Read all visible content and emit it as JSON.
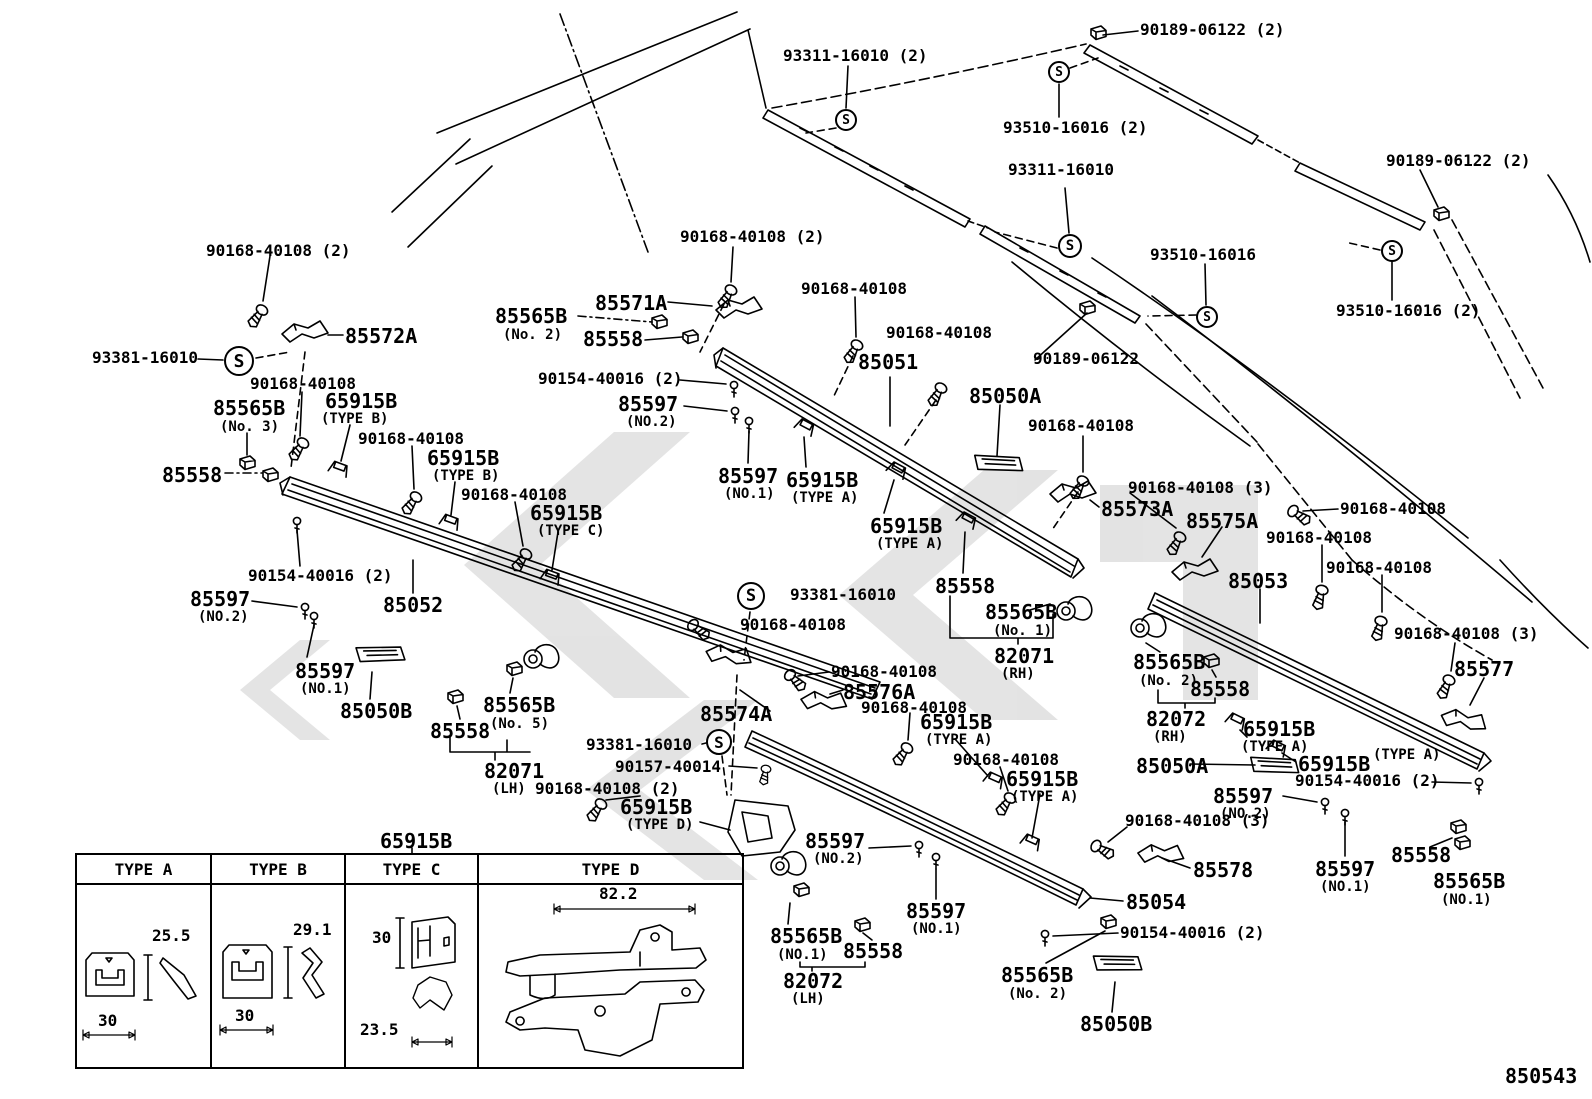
{
  "figure": {
    "number": "850543"
  },
  "s_symbol": "S",
  "watermark_color": "#c9c9c9",
  "table": {
    "title": "65915B",
    "headers": [
      "TYPE A",
      "TYPE B",
      "TYPE C",
      "TYPE D"
    ],
    "dims": {
      "a_h": "25.5",
      "a_w": "30",
      "b_h": "29.1",
      "b_w": "30",
      "c_h": "30",
      "c_w": "23.5",
      "d_w": "82.2"
    }
  },
  "s_marks": [
    {
      "x": 846,
      "y": 120,
      "r": 11
    },
    {
      "x": 1059,
      "y": 72,
      "r": 11
    },
    {
      "x": 1070,
      "y": 246,
      "r": 12
    },
    {
      "x": 1207,
      "y": 317,
      "r": 11
    },
    {
      "x": 1392,
      "y": 251,
      "r": 11
    },
    {
      "x": 239,
      "y": 361,
      "r": 15
    },
    {
      "x": 751,
      "y": 596,
      "r": 14
    },
    {
      "x": 719,
      "y": 742,
      "r": 13
    }
  ],
  "labels": [
    {
      "t": "90189-06122 (2)",
      "x": 1140,
      "y": 22,
      "c": "n"
    },
    {
      "t": "93311-16010 (2)",
      "x": 783,
      "y": 48,
      "c": "n"
    },
    {
      "t": "93510-16016 (2)",
      "x": 1003,
      "y": 120,
      "c": "n"
    },
    {
      "t": "93311-16010",
      "x": 1008,
      "y": 162,
      "c": "n"
    },
    {
      "t": "90189-06122 (2)",
      "x": 1386,
      "y": 153,
      "c": "n"
    },
    {
      "t": "90168-40108 (2)",
      "x": 680,
      "y": 229,
      "c": "n"
    },
    {
      "t": "93510-16016",
      "x": 1150,
      "y": 247,
      "c": "n"
    },
    {
      "t": "90168-40108",
      "x": 801,
      "y": 281,
      "c": "n"
    },
    {
      "t": "85571A",
      "x": 595,
      "y": 293,
      "c": "b"
    },
    {
      "t": "85565B",
      "x": 495,
      "y": 306,
      "c": "b"
    },
    {
      "t": "(No. 2)",
      "x": 503,
      "y": 328,
      "c": "s"
    },
    {
      "t": "85558",
      "x": 583,
      "y": 329,
      "c": "b"
    },
    {
      "t": "93510-16016 (2)",
      "x": 1336,
      "y": 303,
      "c": "n"
    },
    {
      "t": "90168-40108 (2)",
      "x": 206,
      "y": 243,
      "c": "n"
    },
    {
      "t": "85572A",
      "x": 345,
      "y": 326,
      "c": "b"
    },
    {
      "t": "93381-16010",
      "x": 92,
      "y": 350,
      "c": "n"
    },
    {
      "t": "90168-40108",
      "x": 886,
      "y": 325,
      "c": "n"
    },
    {
      "t": "90189-06122",
      "x": 1033,
      "y": 351,
      "c": "n"
    },
    {
      "t": "85051",
      "x": 858,
      "y": 352,
      "c": "b"
    },
    {
      "t": "90168-40108",
      "x": 1028,
      "y": 418,
      "c": "n"
    },
    {
      "t": "85050A",
      "x": 969,
      "y": 386,
      "c": "b"
    },
    {
      "t": "90154-40016 (2)",
      "x": 538,
      "y": 371,
      "c": "n"
    },
    {
      "t": "85597",
      "x": 618,
      "y": 394,
      "c": "b"
    },
    {
      "t": "(NO.2)",
      "x": 626,
      "y": 415,
      "c": "s"
    },
    {
      "t": "90168-40108",
      "x": 250,
      "y": 376,
      "c": "n"
    },
    {
      "t": "85565B",
      "x": 213,
      "y": 398,
      "c": "b"
    },
    {
      "t": "(No. 3)",
      "x": 220,
      "y": 420,
      "c": "s"
    },
    {
      "t": "65915B",
      "x": 325,
      "y": 391,
      "c": "b"
    },
    {
      "t": "(TYPE B)",
      "x": 321,
      "y": 412,
      "c": "s"
    },
    {
      "t": "85558",
      "x": 162,
      "y": 465,
      "c": "b"
    },
    {
      "t": "90168-40108",
      "x": 358,
      "y": 431,
      "c": "n"
    },
    {
      "t": "65915B",
      "x": 427,
      "y": 448,
      "c": "b"
    },
    {
      "t": "(TYPE B)",
      "x": 432,
      "y": 469,
      "c": "s"
    },
    {
      "t": "90168-40108",
      "x": 461,
      "y": 487,
      "c": "n"
    },
    {
      "t": "65915B",
      "x": 530,
      "y": 503,
      "c": "b"
    },
    {
      "t": "(TYPE C)",
      "x": 537,
      "y": 524,
      "c": "s"
    },
    {
      "t": "90154-40016 (2)",
      "x": 248,
      "y": 568,
      "c": "n"
    },
    {
      "t": "85597",
      "x": 190,
      "y": 589,
      "c": "b"
    },
    {
      "t": "(NO.2)",
      "x": 198,
      "y": 610,
      "c": "s"
    },
    {
      "t": "85052",
      "x": 383,
      "y": 595,
      "c": "b"
    },
    {
      "t": "85597",
      "x": 295,
      "y": 661,
      "c": "b"
    },
    {
      "t": "(NO.1)",
      "x": 300,
      "y": 682,
      "c": "s"
    },
    {
      "t": "85050B",
      "x": 340,
      "y": 701,
      "c": "b"
    },
    {
      "t": "85565B",
      "x": 483,
      "y": 695,
      "c": "b"
    },
    {
      "t": "(No. 5)",
      "x": 490,
      "y": 717,
      "c": "s"
    },
    {
      "t": "85558",
      "x": 430,
      "y": 721,
      "c": "b"
    },
    {
      "t": "82071",
      "x": 484,
      "y": 761,
      "c": "b"
    },
    {
      "t": "(LH)",
      "x": 492,
      "y": 782,
      "c": "s"
    },
    {
      "t": "85597",
      "x": 718,
      "y": 466,
      "c": "b"
    },
    {
      "t": "(NO.1)",
      "x": 724,
      "y": 487,
      "c": "s"
    },
    {
      "t": "65915B",
      "x": 786,
      "y": 470,
      "c": "b"
    },
    {
      "t": "(TYPE A)",
      "x": 791,
      "y": 491,
      "c": "s"
    },
    {
      "t": "65915B",
      "x": 870,
      "y": 516,
      "c": "b"
    },
    {
      "t": "(TYPE A)",
      "x": 876,
      "y": 537,
      "c": "s"
    },
    {
      "t": "93381-16010",
      "x": 790,
      "y": 587,
      "c": "n"
    },
    {
      "t": "90168-40108",
      "x": 740,
      "y": 617,
      "c": "n"
    },
    {
      "t": "85558",
      "x": 935,
      "y": 576,
      "c": "b"
    },
    {
      "t": "85565B",
      "x": 985,
      "y": 602,
      "c": "b"
    },
    {
      "t": "(No. 1)",
      "x": 993,
      "y": 624,
      "c": "s"
    },
    {
      "t": "82071",
      "x": 994,
      "y": 646,
      "c": "b"
    },
    {
      "t": "(RH)",
      "x": 1001,
      "y": 667,
      "c": "s"
    },
    {
      "t": "93381-16010",
      "x": 586,
      "y": 737,
      "c": "n"
    },
    {
      "t": "90157-40014",
      "x": 615,
      "y": 759,
      "c": "n"
    },
    {
      "t": "90168-40108 (2)",
      "x": 535,
      "y": 781,
      "c": "n"
    },
    {
      "t": "65915B",
      "x": 620,
      "y": 797,
      "c": "b"
    },
    {
      "t": "(TYPE D)",
      "x": 626,
      "y": 818,
      "c": "s"
    },
    {
      "t": "85574A",
      "x": 700,
      "y": 704,
      "c": "b"
    },
    {
      "t": "90168-40108",
      "x": 831,
      "y": 664,
      "c": "n"
    },
    {
      "t": "85576A",
      "x": 843,
      "y": 682,
      "c": "b"
    },
    {
      "t": "90168-40108",
      "x": 861,
      "y": 700,
      "c": "n"
    },
    {
      "t": "65915B",
      "x": 920,
      "y": 712,
      "c": "b"
    },
    {
      "t": "(TYPE A)",
      "x": 925,
      "y": 733,
      "c": "s"
    },
    {
      "t": "90168-40108",
      "x": 953,
      "y": 752,
      "c": "n"
    },
    {
      "t": "65915B",
      "x": 1006,
      "y": 769,
      "c": "b"
    },
    {
      "t": "(TYPE A)",
      "x": 1011,
      "y": 790,
      "c": "s"
    },
    {
      "t": "90168-40108 (3)",
      "x": 1128,
      "y": 480,
      "c": "n"
    },
    {
      "t": "85573A",
      "x": 1101,
      "y": 499,
      "c": "b"
    },
    {
      "t": "85575A",
      "x": 1186,
      "y": 511,
      "c": "b"
    },
    {
      "t": "90168-40108",
      "x": 1340,
      "y": 501,
      "c": "n"
    },
    {
      "t": "90168-40108",
      "x": 1266,
      "y": 530,
      "c": "n"
    },
    {
      "t": "90168-40108",
      "x": 1326,
      "y": 560,
      "c": "n"
    },
    {
      "t": "85053",
      "x": 1228,
      "y": 571,
      "c": "b"
    },
    {
      "t": "90168-40108 (3)",
      "x": 1394,
      "y": 626,
      "c": "n"
    },
    {
      "t": "85577",
      "x": 1454,
      "y": 659,
      "c": "b"
    },
    {
      "t": "85565B",
      "x": 1133,
      "y": 652,
      "c": "b"
    },
    {
      "t": "(No. 2)",
      "x": 1139,
      "y": 674,
      "c": "s"
    },
    {
      "t": "85558",
      "x": 1190,
      "y": 679,
      "c": "b"
    },
    {
      "t": "82072",
      "x": 1146,
      "y": 709,
      "c": "b"
    },
    {
      "t": "(RH)",
      "x": 1153,
      "y": 730,
      "c": "s"
    },
    {
      "t": "65915B",
      "x": 1243,
      "y": 719,
      "c": "b"
    },
    {
      "t": "(TYPE A)",
      "x": 1241,
      "y": 740,
      "c": "s"
    },
    {
      "t": "65915B",
      "x": 1298,
      "y": 754,
      "c": "b"
    },
    {
      "t": "(TYPE A)",
      "x": 1373,
      "y": 748,
      "c": "s"
    },
    {
      "t": "90154-40016 (2)",
      "x": 1295,
      "y": 773,
      "c": "n"
    },
    {
      "t": "85597",
      "x": 1213,
      "y": 786,
      "c": "b"
    },
    {
      "t": "(NO.2)",
      "x": 1220,
      "y": 807,
      "c": "s"
    },
    {
      "t": "90168-40108 (3)",
      "x": 1125,
      "y": 813,
      "c": "n"
    },
    {
      "t": "85578",
      "x": 1193,
      "y": 860,
      "c": "b"
    },
    {
      "t": "85054",
      "x": 1126,
      "y": 892,
      "c": "b"
    },
    {
      "t": "90154-40016 (2)",
      "x": 1120,
      "y": 925,
      "c": "n"
    },
    {
      "t": "85597",
      "x": 1315,
      "y": 859,
      "c": "b"
    },
    {
      "t": "(NO.1)",
      "x": 1320,
      "y": 880,
      "c": "s"
    },
    {
      "t": "85558",
      "x": 1391,
      "y": 845,
      "c": "b"
    },
    {
      "t": "85565B",
      "x": 1433,
      "y": 871,
      "c": "b"
    },
    {
      "t": "(NO.1)",
      "x": 1441,
      "y": 893,
      "c": "s"
    },
    {
      "t": "85597",
      "x": 805,
      "y": 831,
      "c": "b"
    },
    {
      "t": "(NO.2)",
      "x": 813,
      "y": 852,
      "c": "s"
    },
    {
      "t": "85597",
      "x": 906,
      "y": 901,
      "c": "b"
    },
    {
      "t": "(NO.1)",
      "x": 911,
      "y": 922,
      "c": "s"
    },
    {
      "t": "85565B",
      "x": 770,
      "y": 926,
      "c": "b"
    },
    {
      "t": "(NO.1)",
      "x": 777,
      "y": 948,
      "c": "s"
    },
    {
      "t": "85558",
      "x": 843,
      "y": 941,
      "c": "b"
    },
    {
      "t": "82072",
      "x": 783,
      "y": 971,
      "c": "b"
    },
    {
      "t": "(LH)",
      "x": 791,
      "y": 992,
      "c": "s"
    },
    {
      "t": "85565B",
      "x": 1001,
      "y": 965,
      "c": "b"
    },
    {
      "t": "(No. 2)",
      "x": 1008,
      "y": 987,
      "c": "s"
    },
    {
      "t": "85050B",
      "x": 1080,
      "y": 1014,
      "c": "b"
    },
    {
      "t": "85050A",
      "x": 1136,
      "y": 756,
      "c": "b"
    },
    {
      "t": "65915B",
      "x": 380,
      "y": 831,
      "c": "b"
    }
  ]
}
